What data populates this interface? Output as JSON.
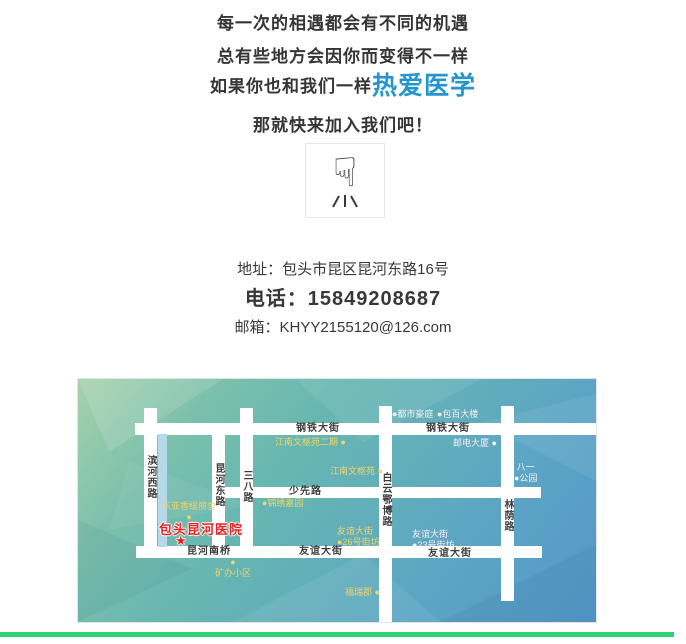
{
  "hero": {
    "line1": "每一次的相遇都会有不同的机遇",
    "line2": "总有些地方会因你而变得不一样",
    "line3_prefix": "如果你也和我们一样",
    "line3_highlight": "热爱医学",
    "line4": "那就快来加入我们吧！",
    "highlight_color": "#2496cd"
  },
  "pointer": {
    "icon": "finger-pointing-down",
    "glyph": "☟"
  },
  "contact": {
    "address": "地址：包头市昆区昆河东路16号",
    "phone": "电话：15849208687",
    "email": "邮箱：KHYY2155120@126.com"
  },
  "map": {
    "hospital": {
      "name": "包头昆河医院",
      "star": "★",
      "color": "#e62222"
    },
    "street_labels": [
      {
        "text": "钢铁大街"
      },
      {
        "text": "钢铁大街"
      },
      {
        "text": "少先路"
      },
      {
        "text": "昆河南桥"
      },
      {
        "text": "友谊大街"
      },
      {
        "text": "友谊大街"
      },
      {
        "text": "滨河西路"
      },
      {
        "text": "昆河东路"
      },
      {
        "text": "三八路"
      },
      {
        "text": "白云鄂博路"
      },
      {
        "text": "林荫路"
      }
    ],
    "poi_labels": [
      {
        "text": "●都市豪庭"
      },
      {
        "text": "●包百大楼"
      },
      {
        "text": "江南文枢苑二期 ●"
      },
      {
        "text": "江南文枢苑 ●"
      },
      {
        "text": "邮电大厦 ●"
      },
      {
        "text": "八一\n●公园"
      },
      {
        "text": "●锦绣嘉园"
      },
      {
        "text": "东亚香缇丽舍\n●"
      },
      {
        "text": "●\n矿办小区"
      },
      {
        "text": "友谊大街\n●26号街坊"
      },
      {
        "text": "友谊大街\n●23号街坊"
      },
      {
        "text": "福瑞郡 ●"
      }
    ],
    "colors": {
      "poi_yellow": "#f2d468",
      "poi_white": "#fbeef0",
      "river": "#b5d9e9"
    }
  },
  "footer": {
    "bar_color": "#2fcf73"
  }
}
